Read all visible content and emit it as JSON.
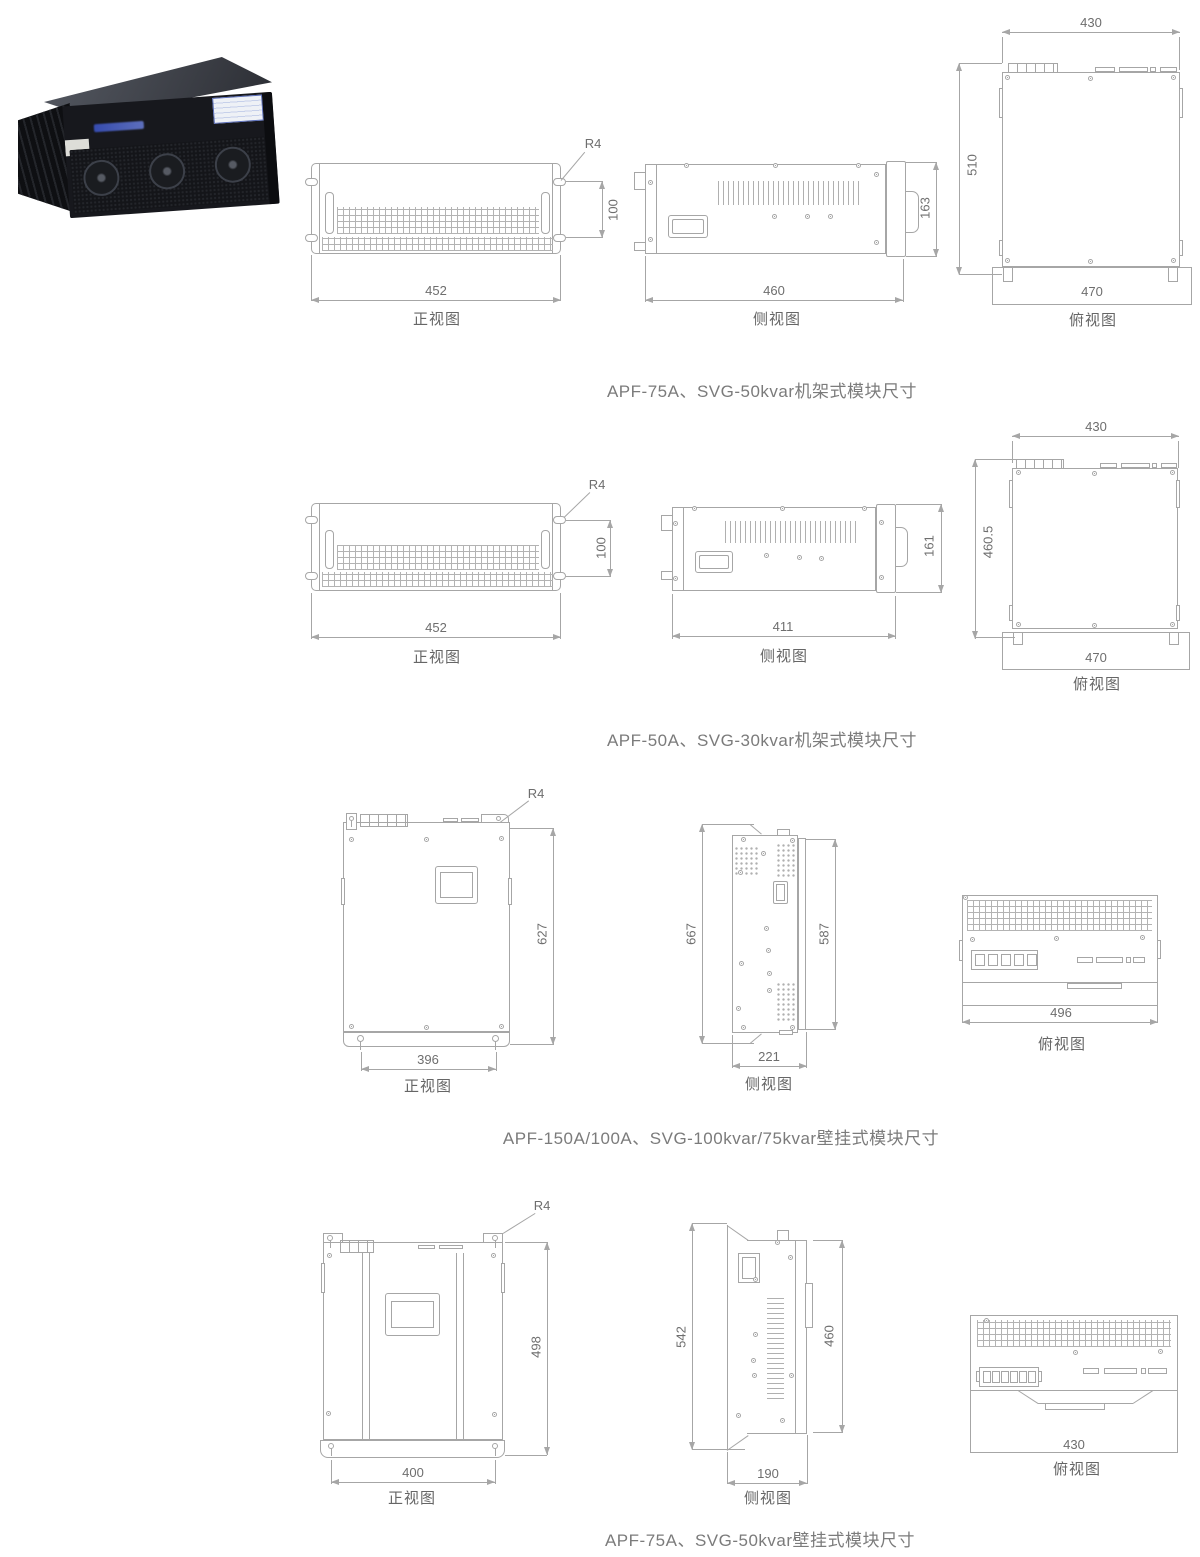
{
  "palette": {
    "background": "#ffffff",
    "line": "#a6a6a6",
    "dimension_text": "#6e6e6e",
    "caption_text": "#7b7b7b"
  },
  "figures": [
    {
      "caption": "APF-75A、SVG-50kvar机架式模块尺寸",
      "front": {
        "label": "正视图",
        "width": "452",
        "height": "100",
        "radius": "R4"
      },
      "side": {
        "label": "侧视图",
        "width": "460",
        "height": "163"
      },
      "top": {
        "label": "俯视图",
        "width_top": "430",
        "height": "510",
        "width_base": "470"
      }
    },
    {
      "caption": "APF-50A、SVG-30kvar机架式模块尺寸",
      "front": {
        "label": "正视图",
        "width": "452",
        "height": "100",
        "radius": "R4"
      },
      "side": {
        "label": "侧视图",
        "width": "411",
        "height": "161"
      },
      "top": {
        "label": "俯视图",
        "width_top": "430",
        "height": "460.5",
        "width_base": "470"
      }
    },
    {
      "caption": "APF-150A/100A、SVG-100kvar/75kvar壁挂式模块尺寸",
      "front": {
        "label": "正视图",
        "width": "396",
        "height": "627",
        "radius": "R4"
      },
      "side": {
        "label": "侧视图",
        "width": "221",
        "height_outer": "667",
        "height_inner": "587"
      },
      "top": {
        "label": "俯视图",
        "width": "496"
      }
    },
    {
      "caption": "APF-75A、SVG-50kvar壁挂式模块尺寸",
      "front": {
        "label": "正视图",
        "width": "400",
        "height": "498",
        "radius": "R4"
      },
      "side": {
        "label": "侧视图",
        "width": "190",
        "height_outer": "542",
        "height_inner": "460"
      },
      "top": {
        "label": "俯视图",
        "width": "430"
      }
    }
  ]
}
